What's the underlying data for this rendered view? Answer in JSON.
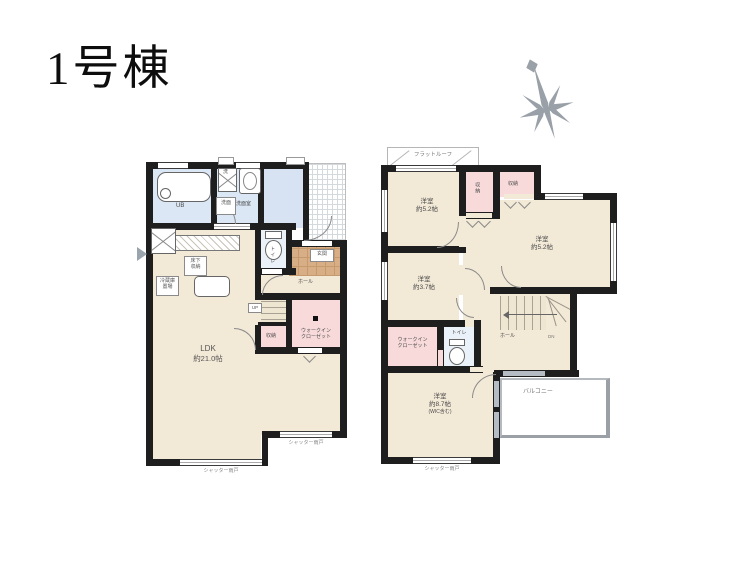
{
  "title": "1号棟",
  "f1": {
    "ub": "UB",
    "washer": "洗",
    "senmen_box": "洗面",
    "senmen": "洗面室",
    "toilet": "トイレ",
    "genkan": "玄関",
    "hall": "ホール",
    "up": "UP",
    "closet": "収納",
    "wic_line1": "ウォークイン",
    "wic_line2": "クローゼット",
    "ldk": "LDK",
    "ldk_size": "約21.0帖",
    "underfloor_line1": "床下",
    "underfloor_line2": "収納",
    "fridge_line1": "冷蔵庫",
    "fridge_line2": "置場",
    "shutter": "シャッター雨戸"
  },
  "f2": {
    "flat_roof": "フラットルーフ",
    "room1_name": "洋室",
    "room1_size": "約5.2帖",
    "room2_name": "洋室",
    "room2_size": "約5.2帖",
    "room3_name": "洋室",
    "room3_size": "約3.7帖",
    "room4_name": "洋室",
    "room4_size": "約8.7帖",
    "room4_note": "(WIC含む)",
    "closet_a": "収納",
    "closet_b": "収納",
    "wic_line1": "ウォークイン",
    "wic_line2": "クローゼット",
    "toilet": "トイレ",
    "hall": "ホール",
    "dn": "DN",
    "balcony": "バルコニー",
    "shutter": "シャッター雨戸"
  },
  "colors": {
    "floor_beige": "#f3e9d7",
    "wet_blue": "#dbe7f4",
    "closet_pink": "#f8dada",
    "entrance_tile": "#d7ae85",
    "wall": "#1e1e1e"
  }
}
